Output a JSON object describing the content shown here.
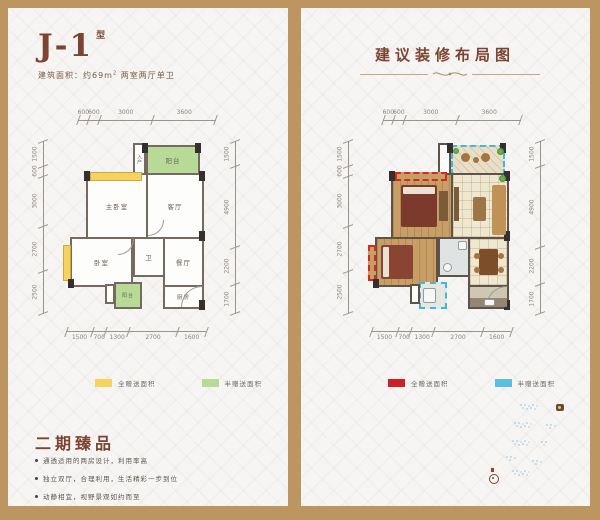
{
  "frame_color": "#bd9560",
  "left": {
    "title": "J-1",
    "title_tag": "型",
    "area_label": "建筑面积：约69m",
    "area_sup": "2",
    "area_rest": " 两室两厅单卫",
    "rooms": {
      "balcony_top": "阳台",
      "entry": "入户",
      "living": "客厅",
      "master": "主卧室",
      "bedroom": "卧室",
      "bath": "卫",
      "dining": "餐厅",
      "kitchen": "厨房",
      "balcony_bottom": "阳台"
    },
    "dims": {
      "top": [
        "600",
        "600",
        "3000",
        "3600"
      ],
      "left": [
        "1500",
        "600",
        "3000",
        "2700",
        "2500"
      ],
      "right": [
        "1500",
        "4900",
        "2200",
        "1700"
      ],
      "bottom": [
        "1500",
        "700",
        "1300",
        "2700",
        "1600"
      ]
    },
    "legend": [
      {
        "color": "#f6d25e",
        "label": "全赠送面积"
      },
      {
        "color": "#b7db97",
        "label": "半赠送面积"
      }
    ],
    "section_title": "二期臻品",
    "bullets": [
      "通透适用的两房设计，利用率高",
      "独立双厅，合理利用，生活精彩一步到位",
      "动静相宜，视野景观如约而至"
    ]
  },
  "right": {
    "title": "建议装修布局图",
    "dims": {
      "top": [
        "600",
        "600",
        "3000",
        "3600"
      ],
      "left": [
        "1500",
        "600",
        "3000",
        "2700",
        "2500"
      ],
      "right": [
        "1500",
        "4900",
        "2200",
        "1700"
      ],
      "bottom": [
        "1500",
        "700",
        "1300",
        "2700",
        "1600"
      ]
    },
    "legend": [
      {
        "color": "#cc2127",
        "label": "全赠送面积"
      },
      {
        "color": "#5bbfe4",
        "label": "半赠送面积"
      }
    ]
  }
}
